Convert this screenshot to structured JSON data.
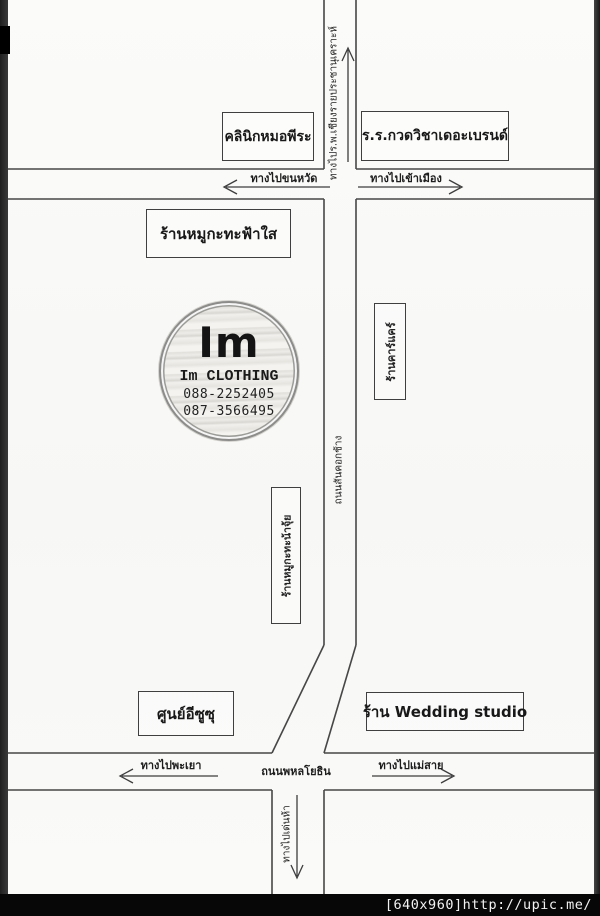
{
  "page": {
    "watermark": "[640x960]http://upic.me/",
    "background_color": "#f8f8f6",
    "line_color": "#4a4a4a"
  },
  "logo": {
    "initials": "Im",
    "shop_name": "Im CLOTHING",
    "phone_1": "088-2252405",
    "phone_2": "087-3566495"
  },
  "landmarks": {
    "clinic": "คลินิกหมอพีระ",
    "tutoring_school": "ร.ร.กวดวิชาเดอะเบรนด์",
    "mookata_fahsai": "ร้านหมูกะทะฟ้าใส",
    "car_care": "ร้านคาร์แคร์",
    "mookata_najui": "ร้านหมูกะทะน้าจุ้ย",
    "isuzu_center": "ศูนย์อีซูซุ",
    "wedding_studio": "ร้าน Wedding studio"
  },
  "roads": {
    "to_hospital": "ทางไปร.พ.เชียงรายประชานุเคราะห์",
    "san_khok_chang_road": "ถนนสันคอกช้าง",
    "phahonyothin_road": "ถนนพหลโยธิน",
    "to_west_top": "ทางไปขนหวัด",
    "to_city": "ทางไปเข้าเมือง",
    "to_phayao": "ทางไปพะเยา",
    "to_maesai": "ทางไปแม่สาย",
    "to_denha": "ทางไปเด่นห้า"
  }
}
